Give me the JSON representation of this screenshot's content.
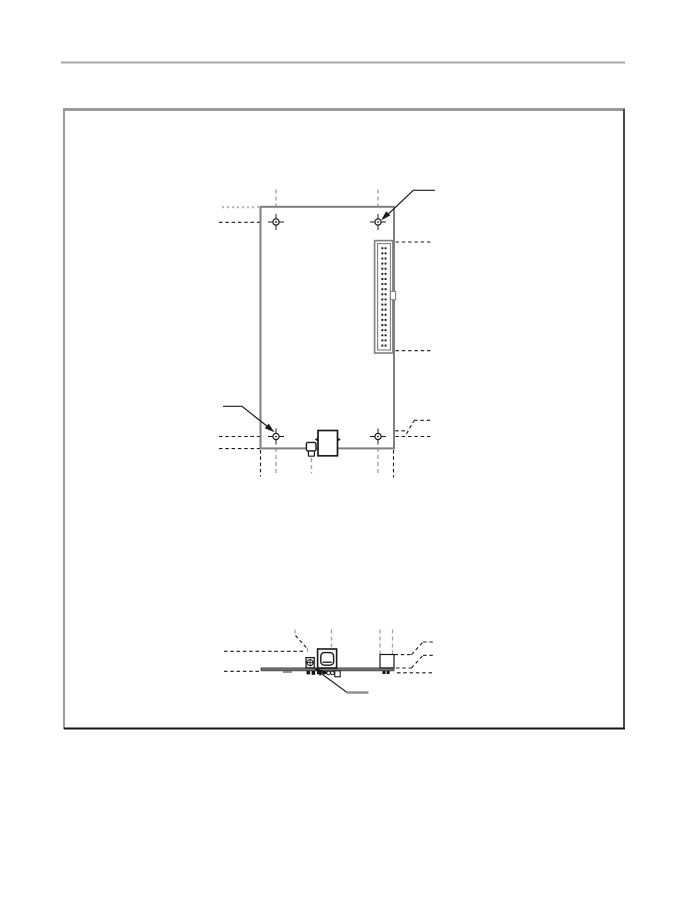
{
  "page": {
    "background": "#ffffff",
    "width": 700,
    "height": 900
  },
  "header": {
    "rule_color": "#a8a8a8"
  },
  "figure_frame": {
    "border_light": "#9a9a9a",
    "border_right": "#4a4a4a",
    "border_bottom": "#161616"
  },
  "colors": {
    "board_outline": "#7f7f7f",
    "component_outline": "#1a1a1a",
    "centerline_black": "#1a1a1a",
    "centerline_gray": "#a3a3a3",
    "dotted_gray": "#b5b5b5",
    "leader": "#1a1a1a",
    "label_bar_gray": "#8c8c8c",
    "board_side_fill": "#757575",
    "pin_black": "#111111"
  },
  "top_view": {
    "mounting_holes": [
      {
        "x": 276,
        "y": 222
      },
      {
        "x": 378,
        "y": 222
      },
      {
        "x": 276,
        "y": 436.5
      },
      {
        "x": 378,
        "y": 436.5
      }
    ],
    "connector": {
      "pin_rows": 20,
      "pin_cols": 2
    }
  },
  "side_view": {
    "leader_arrow": "points to through-hole pins under board"
  }
}
